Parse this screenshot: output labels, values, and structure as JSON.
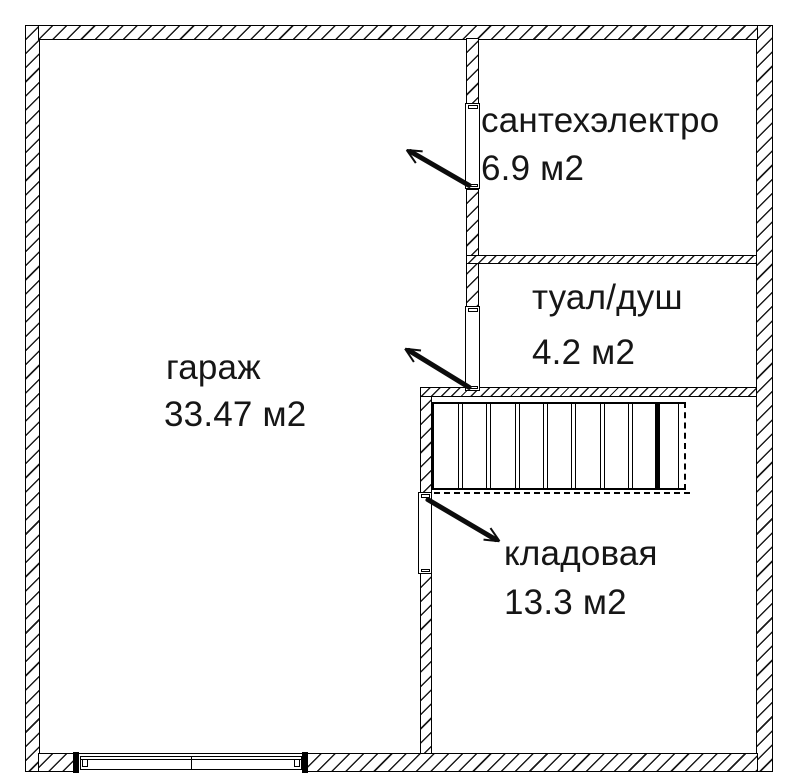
{
  "plan": {
    "type": "floor-plan",
    "background_color": "#ffffff",
    "line_color": "#000000",
    "rooms": [
      {
        "label": "гараж",
        "area": "33.47 м2"
      },
      {
        "label": "сантехэлектро",
        "area": "6.9 м2"
      },
      {
        "label": "туал/душ",
        "area": "4.2 м2"
      },
      {
        "label": "кладовая",
        "area": "13.3 м2"
      }
    ],
    "staircase": {
      "tread_lines": 9
    },
    "door_count": 3,
    "garage_gate_sections": 2
  }
}
